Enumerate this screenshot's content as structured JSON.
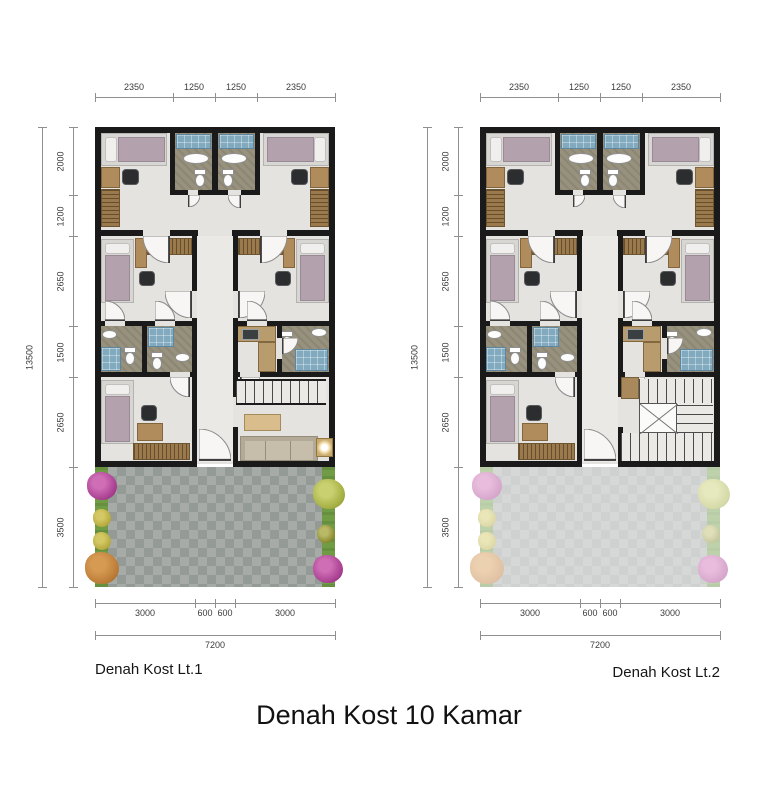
{
  "title": "Denah Kost 10 Kamar",
  "plans": [
    {
      "label": "Denah Kost Lt.1",
      "dims": {
        "top": [
          "2350",
          "1250",
          "1250",
          "2350"
        ],
        "left": [
          "2000",
          "1200",
          "2650",
          "1500",
          "2650",
          "3500"
        ],
        "left_total": "13500",
        "bottom": [
          "3000",
          "600",
          "600",
          "3000"
        ],
        "bottom_total": "7200"
      }
    },
    {
      "label": "Denah Kost Lt.2",
      "dims": {
        "top": [
          "2350",
          "1250",
          "1250",
          "2350"
        ],
        "left": [
          "2000",
          "1200",
          "2650",
          "1500",
          "2650",
          "3500"
        ],
        "left_total": "13500",
        "bottom": [
          "3000",
          "600",
          "600",
          "3000"
        ],
        "bottom_total": "7200"
      }
    }
  ]
}
